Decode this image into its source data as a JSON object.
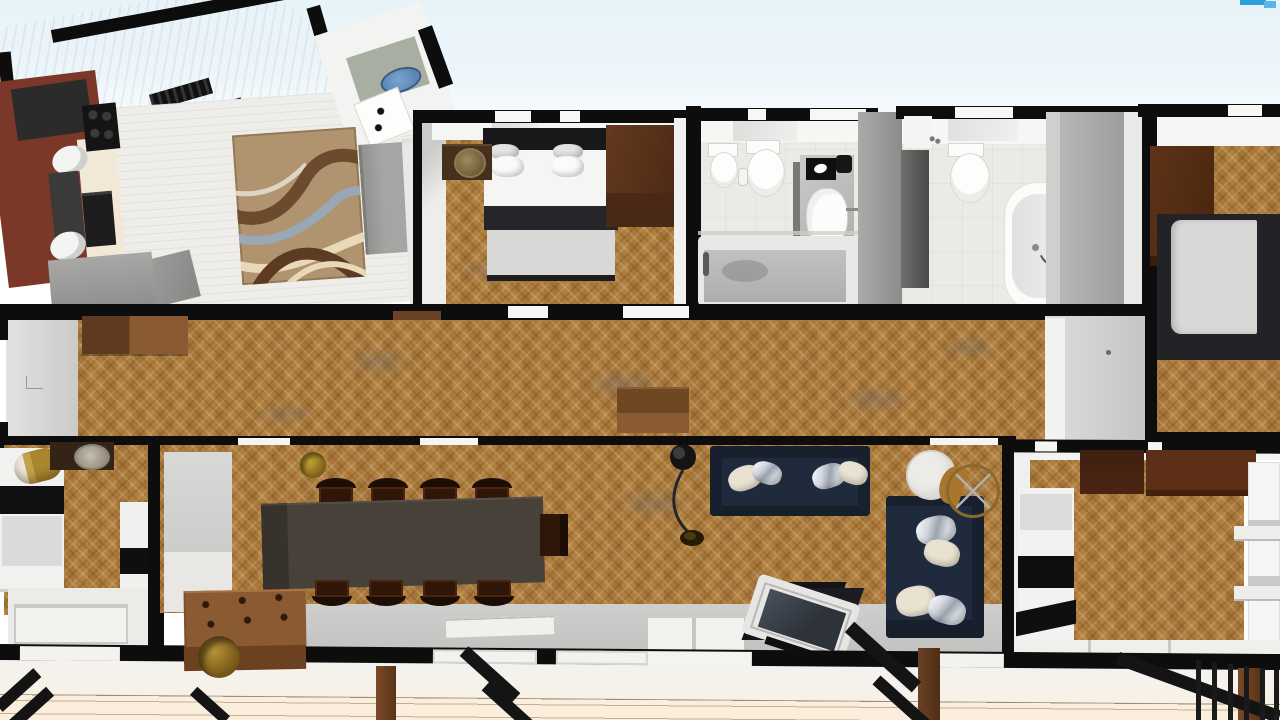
{
  "view": {
    "type": "3d-top-down-floor-plan-render",
    "ui_text_visible": "none"
  },
  "palette": {
    "sky": "#e8f3f9",
    "cream": "#faeedd",
    "wall": "#0d0d0d",
    "wallface": "#f3f3f1",
    "parquet": "#b5823f",
    "plank": "#efede9",
    "tile": "#ebeae6",
    "grayfloor": "#cbcbc9",
    "roof": "#c8c8c8",
    "maroon": "#7b3829",
    "creamcab": "#f2e8d8",
    "navy": "#1f2b3d",
    "navydark": "#18202e",
    "wooddark": "#42220f",
    "woodmid": "#6b4226",
    "woodlight": "#8a5a33",
    "beddark": "#232327",
    "bedlight": "#d8d8d6",
    "whitefix": "#f4f4f2",
    "gold": "#a8862e",
    "tan": "#b0936f",
    "rugbrown": "#6b4a2e",
    "ruggray": "#9aa7b5",
    "rugcream": "#ead9b9",
    "blue": "#5b87b8",
    "graysofa": "#9c9c9c",
    "tabletop": "#48413a",
    "graypanel": "#9a9a98"
  },
  "scene": {
    "rooms": [
      {
        "id": "kitchen",
        "floor": "gray-and-cabinets",
        "furniture": [
          "l-shaped-maroon-counter",
          "cooktop",
          "oven",
          "double-sink",
          "base-cabinet",
          "sloped-roof-with-vents"
        ]
      },
      {
        "id": "living-room",
        "floor": "white-plank",
        "furniture": [
          "area-rug-swirl",
          "gray-sofa",
          "gray-lowboard",
          "white-tall-cabinet",
          "washbasin-nook",
          "white-appliance-box"
        ]
      },
      {
        "id": "bedroom-1",
        "floor": "parquet",
        "furniture": [
          "double-bed-4-pillows",
          "nightstand-with-plant",
          "brown-wardrobe"
        ]
      },
      {
        "id": "bathroom-1",
        "floor": "tile",
        "furniture": [
          "toilet",
          "bidet",
          "vanity-with-mirror",
          "washbasin",
          "bathtub-shower"
        ]
      },
      {
        "id": "bathroom-2",
        "floor": "tile",
        "furniture": [
          "toilet",
          "freestanding-bathtub",
          "dark-vanity",
          "shower-mixer",
          "gray-partition"
        ]
      },
      {
        "id": "bedroom-2",
        "floor": "parquet",
        "furniture": [
          "bed-side-view",
          "brown-wardrobe"
        ]
      },
      {
        "id": "hallway",
        "floor": "parquet",
        "furniture": [
          "two-tone-sideboard",
          "storage-chest",
          "gray-closet"
        ]
      },
      {
        "id": "bedroom-3",
        "floor": "parquet",
        "furniture": [
          "bed-black-white",
          "gold-cylinder-lamp",
          "nightstand-with-basket",
          "striped-unit",
          "window"
        ]
      },
      {
        "id": "dining-living-room",
        "floor": "parquet",
        "furniture": [
          "long-dining-table",
          "nine-chairs",
          "wood-chest-coffee-table",
          "gold-planter-x2",
          "arc-floor-lamp",
          "navy-sofa",
          "navy-chaise-sofa",
          "throw-pillows",
          "round-marble-side-table",
          "rattan-round-chair",
          "tv-on-black-stand",
          "glass-doors"
        ]
      },
      {
        "id": "bedroom-4",
        "floor": "parquet",
        "furniture": [
          "bed-black-white",
          "dark-wardrobe",
          "white-shelving-unit",
          "window"
        ]
      },
      {
        "id": "terrace",
        "floor": "deck-planks",
        "furniture": [
          "wood-posts",
          "diagonal-braces",
          "vertical-bar-railing"
        ]
      }
    ]
  }
}
